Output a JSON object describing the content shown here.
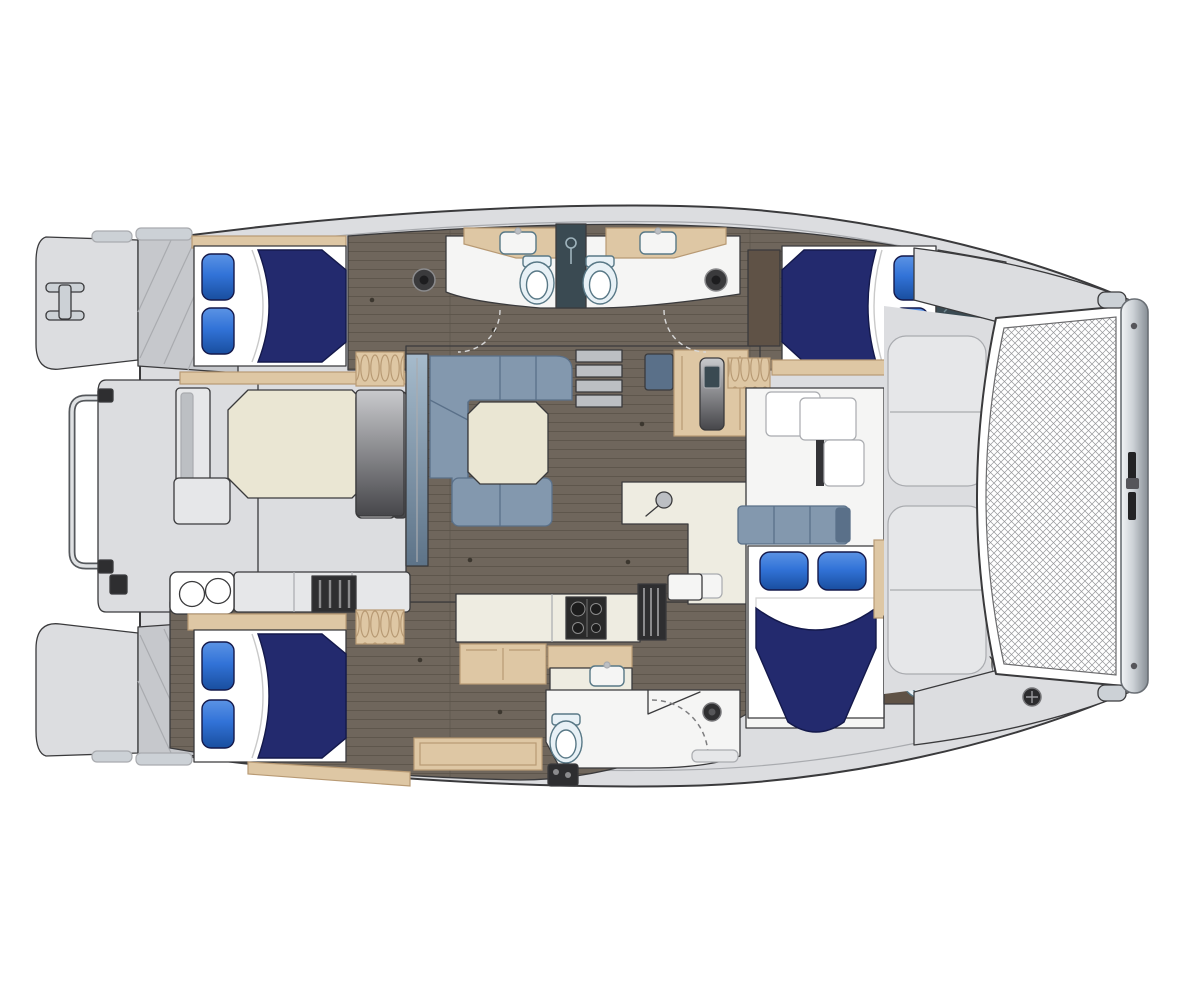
{
  "document": {
    "type": "yacht floor plan illustration",
    "subject": "Catamaran accommodation and deck layout, top-down plan view",
    "orientation": {
      "bow": "right",
      "stern": "left",
      "port_hull": "top",
      "starboard_hull": "bottom"
    },
    "visible_text": "none"
  },
  "palette": {
    "white": "#ffffff",
    "deck": "#dcdde0",
    "deck_dark": "#c6c8cc",
    "deck_pad": "#e6e7e9",
    "soft_line": "#a9abaf",
    "line": "#3a3a3c",
    "room": "#f5f5f4",
    "floor": "#6f665c",
    "floor_line": "#5b5349",
    "wood": "#dec7a4",
    "wood_dark": "#b89a74",
    "wood_deep": "#5f5246",
    "navy": "#232a6e",
    "navy_dark": "#14194b",
    "pillow": "#3273d8",
    "pillow_dark": "#194e9e",
    "sofa": "#8398ae",
    "sofa_dark": "#5a7089",
    "cream": "#eae6d3",
    "counter": "#eeece1",
    "slate": "#3a4a52",
    "toilet": "#e8f1f6",
    "toilet_edge": "#587886",
    "metal": "#ccd1d6",
    "metal_dark": "#878e95",
    "stove": "#2a2a2a",
    "equip": "#2e2e30",
    "grayfurn": "#bcbfc3",
    "mesh_line": "#96979a"
  },
  "layout": {
    "stern": {
      "features": [
        "port swim platform with molded steps",
        "starboard swim platform with molded steps",
        "aft davit rail between hulls",
        "I-shaped mooring cleat",
        "shore power box"
      ]
    },
    "cockpit": {
      "features": [
        "octagonal dining table",
        "bench seating on three sides",
        "wet bar with twin round burners",
        "sliding glass door to salon"
      ]
    },
    "salon": {
      "features": [
        "L-shaped lounge settee",
        "square coffee table",
        "navigation desk with seat",
        "L-shaped counter with round sink",
        "companionway steps down to port hull"
      ]
    },
    "galley": {
      "features": [
        "cooktop with burners",
        "double sink",
        "wood counter",
        "drawer cabinets",
        "companionway steps down to starboard hull"
      ]
    },
    "port_hull": {
      "aft_cabin": [
        "double berth with navy duvet",
        "two blue pillows",
        "hanging locker"
      ],
      "heads": [
        "two toilets",
        "two vanity counters with sinks",
        "central shower column",
        "two round deck fittings",
        "door swing arcs"
      ],
      "forward_cabin": [
        "double berth with navy duvet",
        "two blue pillows",
        "dark vanity unit",
        "hanging locker",
        "forepeak storage hatch"
      ]
    },
    "starboard_hull": {
      "aft_cabin": [
        "double berth with navy duvet",
        "two blue pillows",
        "hanging locker",
        "step locker"
      ],
      "aft_head": [
        "toilet",
        "shower stall with curved door and drain",
        "wood bench",
        "water heater unit"
      ],
      "forward_cabin": [
        "double berth with navy duvet",
        "two blue pillows",
        "three-seat settee",
        "stepped lockers",
        "private head with toilet, cabinet and sink"
      ]
    },
    "foredeck": {
      "features": [
        "two molded lounge pads",
        "trampoline net",
        "forward crossbeam with center fitting",
        "anchor windlass fitting",
        "bow rollers"
      ]
    },
    "totals": {
      "cabins": 4,
      "double_berths": 4,
      "toilets": 4,
      "visible_sinks": 5,
      "showers": 2
    }
  }
}
